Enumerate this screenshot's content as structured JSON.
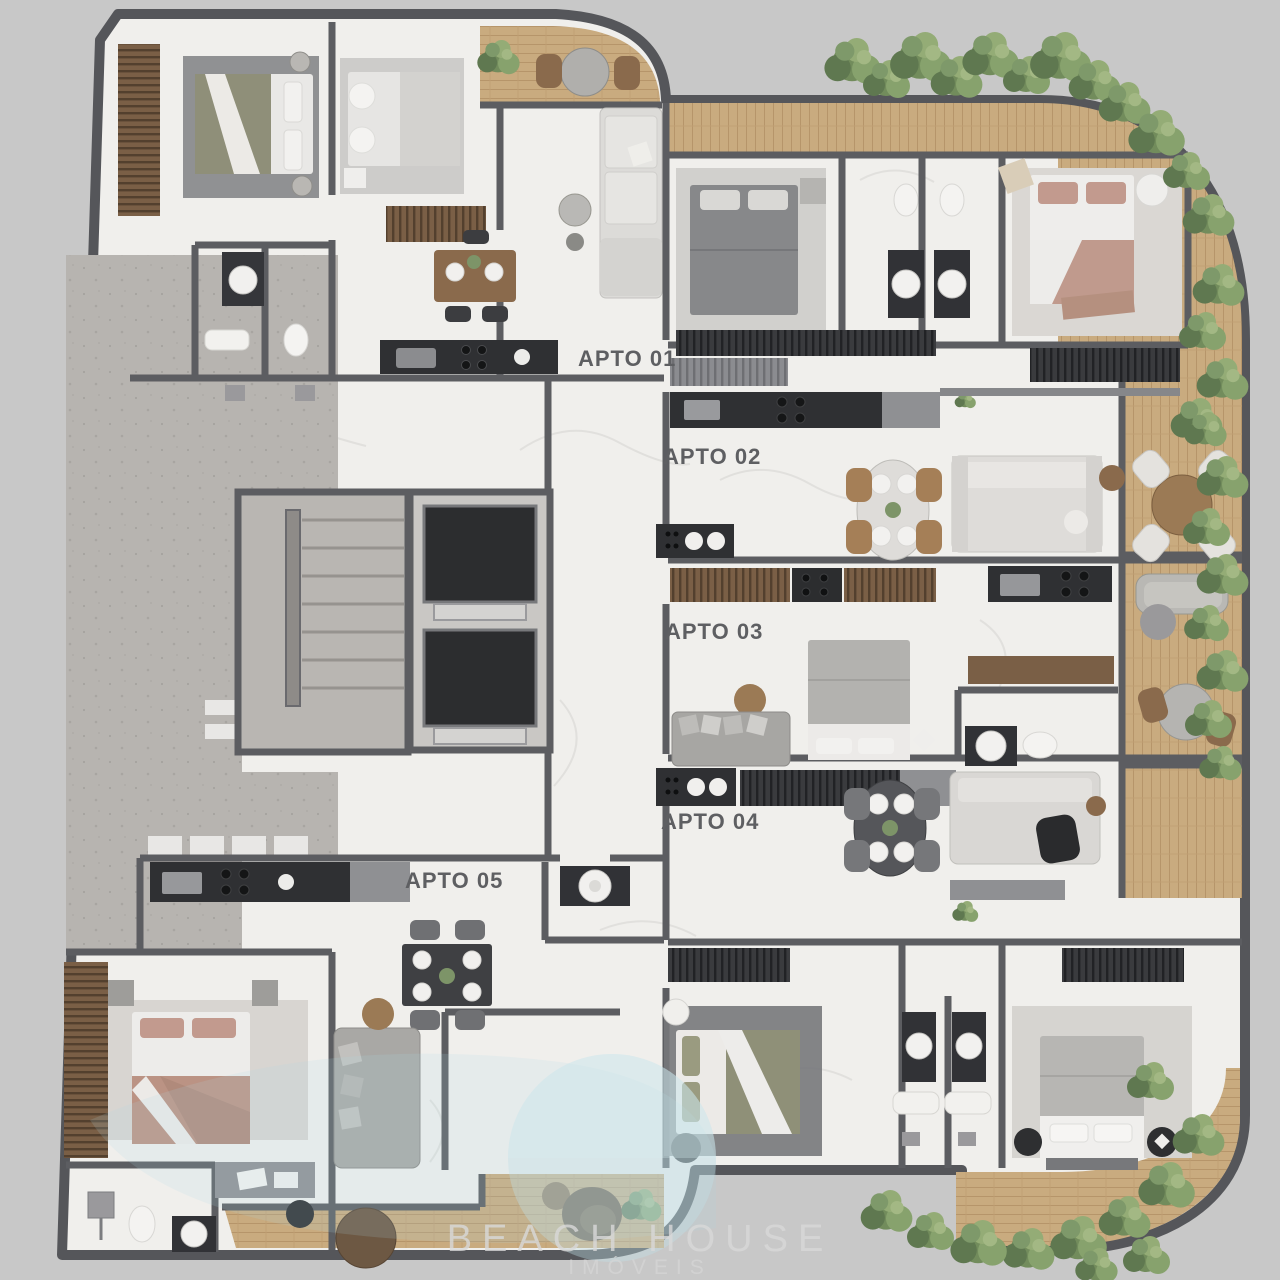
{
  "units": [
    {
      "id": "apto-01",
      "label": "APTO 01"
    },
    {
      "id": "apto-02",
      "label": "APTO 02"
    },
    {
      "id": "apto-03",
      "label": "APTO 03"
    },
    {
      "id": "apto-04",
      "label": "APTO 04"
    },
    {
      "id": "apto-05",
      "label": "APTO 05"
    }
  ],
  "watermark": {
    "line1": "BEACH HOUSE",
    "line2": "IMÓVEIS"
  },
  "palette": {
    "background": "#c8c8c8",
    "outer_wall": "#55565a",
    "inner_wall": "#5c5d61",
    "marble_floor": "#f0efec",
    "concrete_floor": "#b7b4b0",
    "wood_deck": "#c9ab7f",
    "hedge_green": "#7d9468",
    "dark_fixture": "#2f3033",
    "label_text": "#5e5f62",
    "watermark_tint": "#a9d3dc"
  }
}
